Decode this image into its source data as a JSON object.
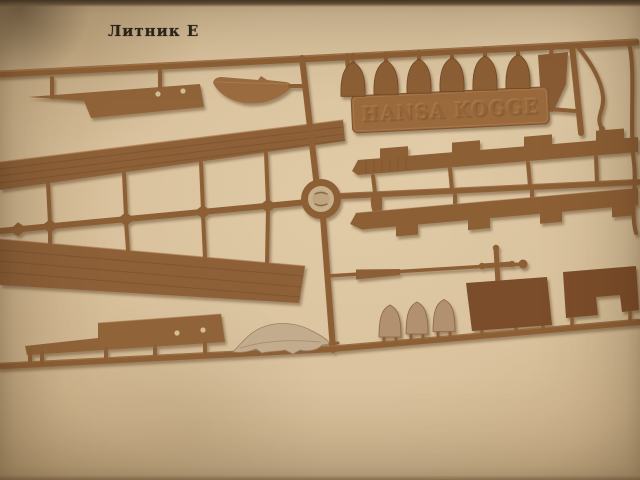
{
  "photo": {
    "caption": "Литник Е",
    "nameplate_text": "HANSA KOGGE",
    "subject": "brown injection-molded model-kit sprue photographed on beige paper",
    "visible_counts": {
      "top_shields": 6,
      "bottom_shields": 3,
      "dark_panels": 2,
      "deck_planks": 2
    },
    "colors": {
      "paper": "#d9c29d",
      "paper_edge": "#b3976f",
      "plastic": "#8d5f36",
      "plastic_dark": "#6f4727",
      "plastic_light": "#b0855a",
      "dark_panel": "#7b4e2b",
      "light_part": "#c3ac8e",
      "caption_ink": "#2a231c"
    },
    "parts": [
      "deck-side-panel-with-holes",
      "half-deck-crescent",
      "upper-deck-plank",
      "lower-deck-plank",
      "runner-hub",
      "upper-bulwark-strip",
      "lower-bulwark-strip",
      "heraldic-shield-row",
      "name-plate",
      "rudder-blade",
      "curved-davit-rod",
      "right-edge-rod",
      "mast-spar-with-cross",
      "bottom-side-panel-with-holes",
      "ship-boat-hull",
      "small-shield-trio",
      "dark-stern-panels"
    ]
  }
}
